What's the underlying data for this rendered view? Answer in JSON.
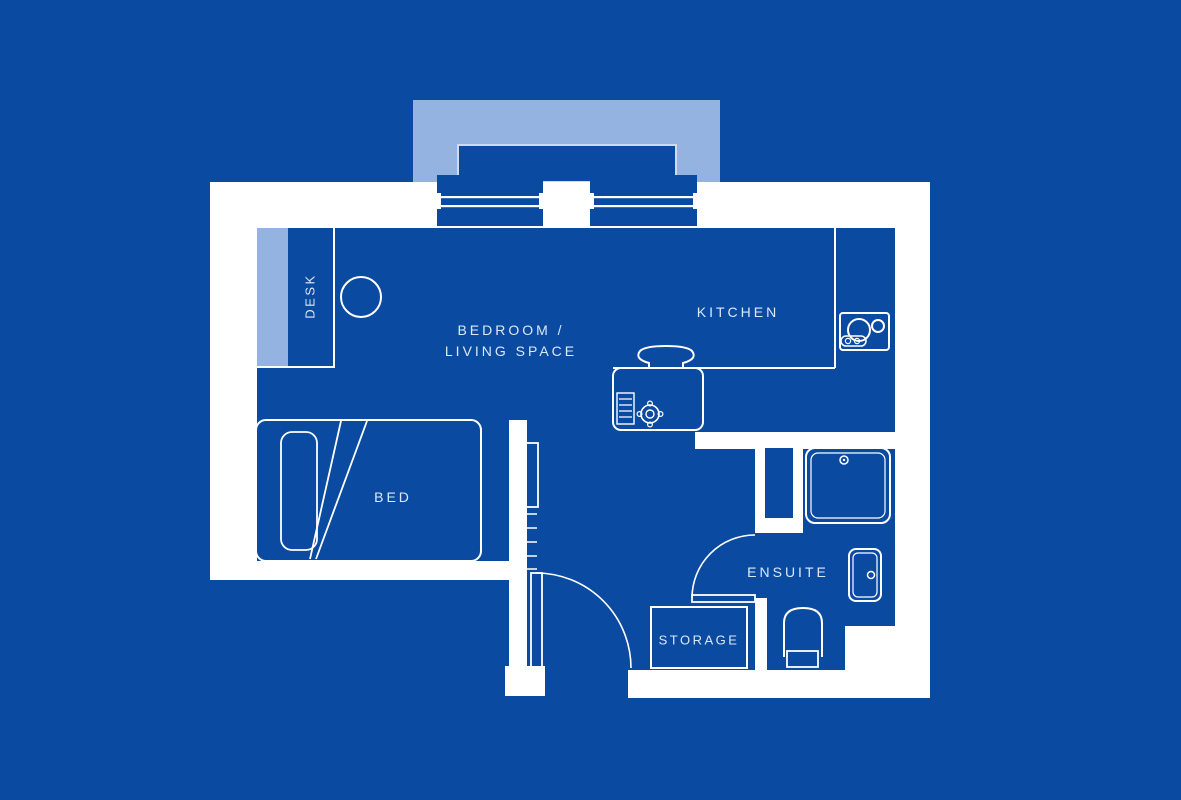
{
  "palette": {
    "background": "#0b4aa1",
    "wall": "#ffffff",
    "accent_light_blue": "#95b3e0",
    "line": "#ffffff",
    "text": "#dce8f8"
  },
  "floorplan": {
    "labels": {
      "bedroom_line1": "BEDROOM /",
      "bedroom_line2": "LIVING SPACE",
      "kitchen": "KITCHEN",
      "bed": "BED",
      "desk": "DESK",
      "ensuite": "ENSUITE",
      "storage": "STORAGE"
    },
    "fixture_icons": [
      "bed-icon",
      "pillow-icon",
      "duvet-fold-icon",
      "desk-chair-icon",
      "desk-icon",
      "kitchen-sink-icon",
      "tap-icon",
      "drainer-icon",
      "hob-icon",
      "radiator-icon",
      "entry-door-icon",
      "ensuite-door-icon",
      "shower-tray-icon",
      "wash-basin-icon",
      "toilet-icon",
      "storage-cupboard-icon",
      "window-icon",
      "balcony-icon",
      "service-shaft-icon"
    ]
  }
}
